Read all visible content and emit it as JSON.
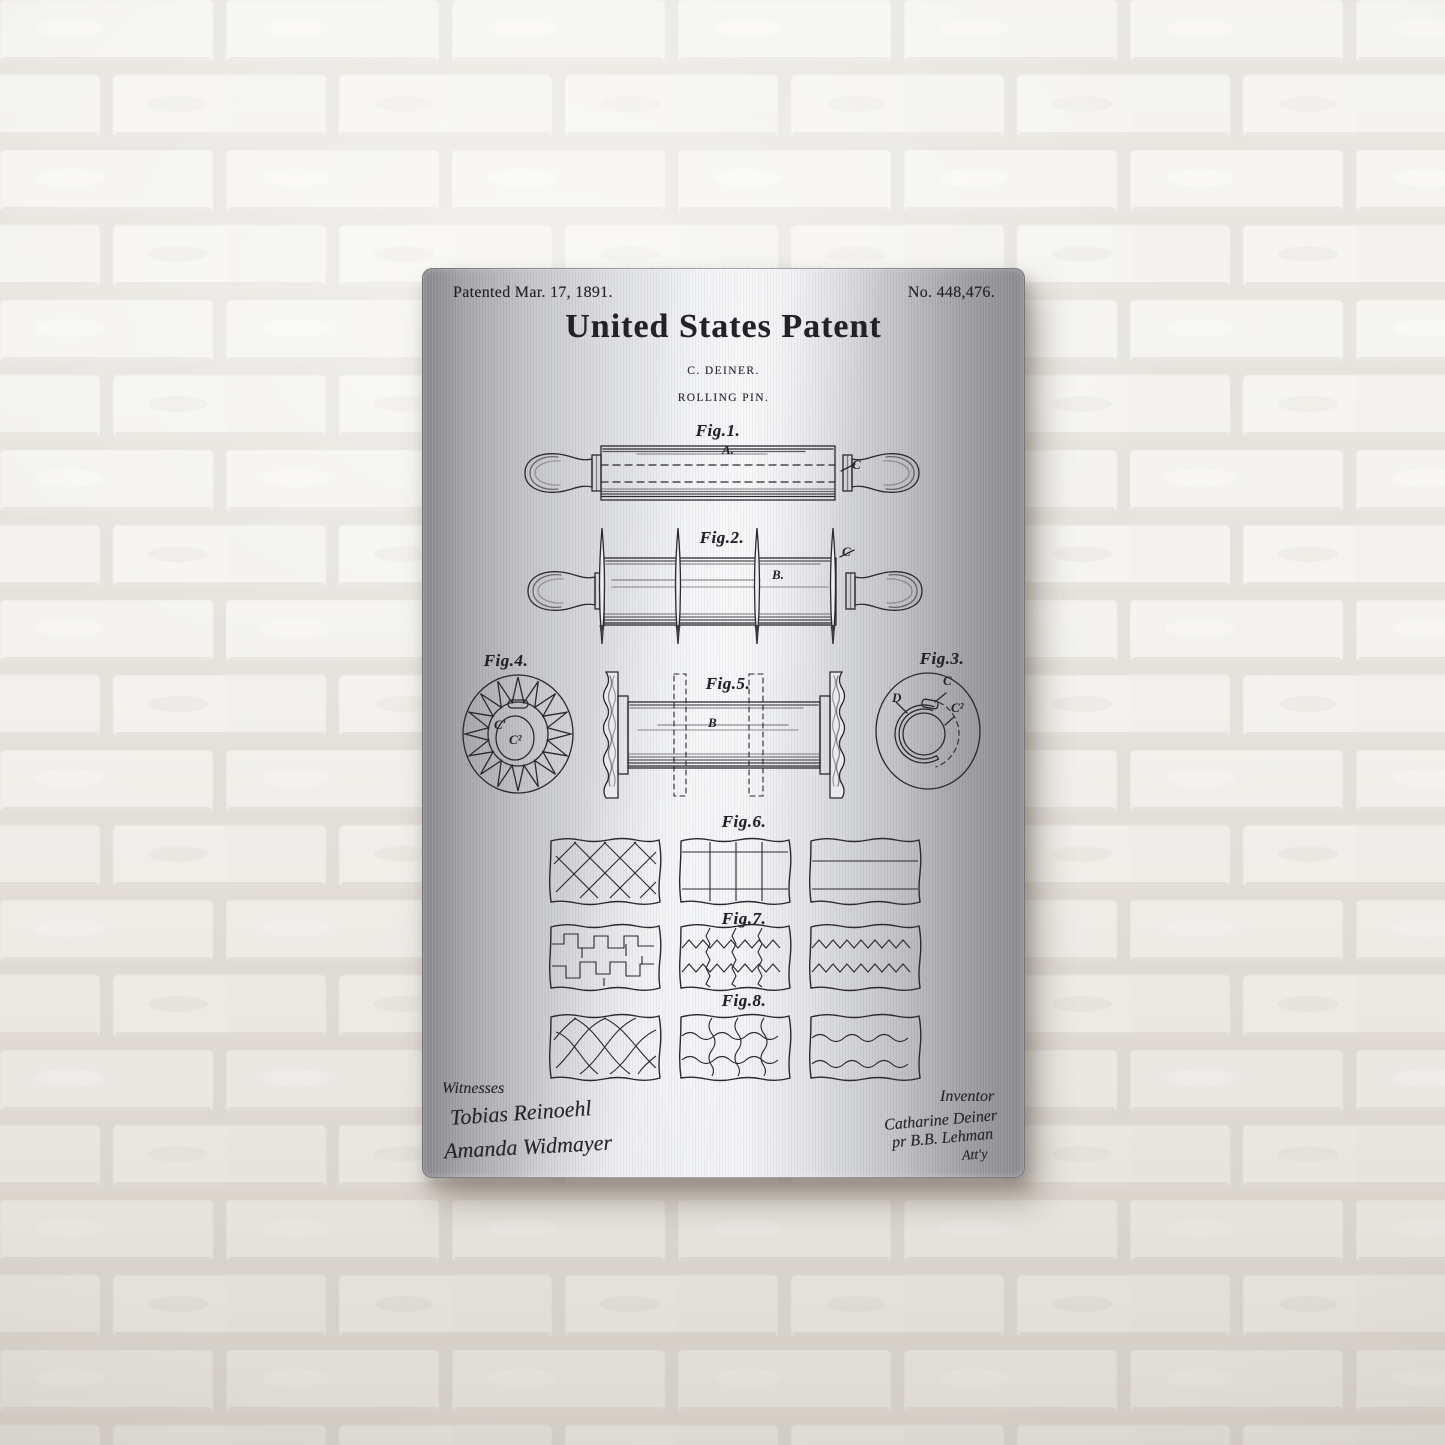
{
  "header": {
    "patented": "Patented Mar. 17, 1891.",
    "number": "No. 448,476.",
    "title": "United States Patent",
    "inventor_line": "C. DEINER.",
    "subject_line": "ROLLING PIN."
  },
  "figures": {
    "fig1": {
      "label": "Fig.1.",
      "part_a": "A.",
      "part_c": "C"
    },
    "fig2": {
      "label": "Fig.2.",
      "part_b": "B.",
      "part_c": "C"
    },
    "fig3": {
      "label": "Fig.3.",
      "part_d": "D",
      "part_c": "C",
      "part_c2": "C²"
    },
    "fig4": {
      "label": "Fig.4.",
      "part_c1": "C′",
      "part_c2": "C²"
    },
    "fig5": {
      "label": "Fig.5.",
      "part_b": "B"
    },
    "fig6": {
      "label": "Fig.6."
    },
    "fig7": {
      "label": "Fig.7."
    },
    "fig8": {
      "label": "Fig.8."
    }
  },
  "footer": {
    "witnesses_label": "Witnesses",
    "witness1": "Tobias Reinoehl",
    "witness2": "Amanda Widmayer",
    "inventor_label": "Inventor",
    "inventor_sig1": "Catharine Deiner",
    "inventor_sig2": "pr B.B. Lehman",
    "inventor_sig3": "Att'y"
  },
  "colors": {
    "ink": "#232327",
    "metal_light": "#f3f4f6",
    "metal_dark": "#87878b",
    "wall_brick": "#f4f3ef",
    "wall_mortar": "#e6e3dd"
  }
}
